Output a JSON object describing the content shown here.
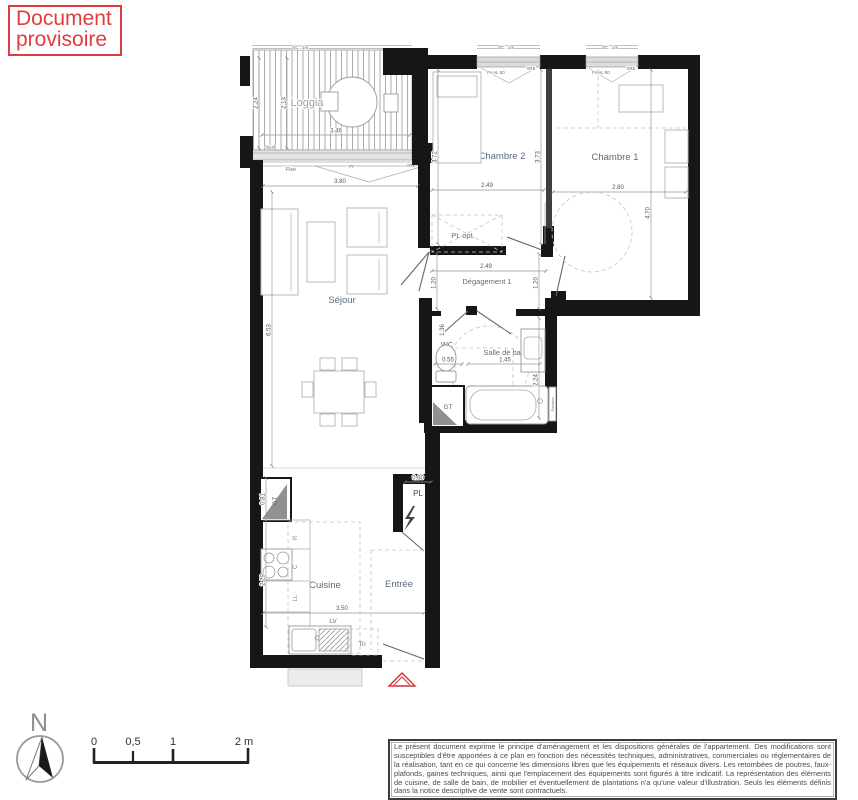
{
  "stamp": {
    "line1": "Document",
    "line2": "provisoire"
  },
  "plan": {
    "rooms": {
      "loggia": {
        "label": "Loggia",
        "width": "3.46",
        "depth_outer": "2.24",
        "depth_inner": "2.13"
      },
      "sejour": {
        "label": "Séjour",
        "width": "3.80",
        "height": "6.53"
      },
      "chambre2": {
        "label": "Chambre 2",
        "width": "2.49",
        "height_left": "3.72",
        "height_right": "3.73"
      },
      "chambre1": {
        "label": "Chambre 1",
        "width": "2.80",
        "height": "4.70"
      },
      "degagement": {
        "label": "Dégagement 1",
        "width": "2.49",
        "height_left": "1.20",
        "height_right": "1.20"
      },
      "wc": {
        "label": "WC",
        "width": "0.55",
        "height": "1.36"
      },
      "salle_de_bain": {
        "label": "Salle de bain",
        "width": "1.45",
        "height": "2.24"
      },
      "cuisine": {
        "label": "Cuisine",
        "width": "3.50",
        "counter_height": "2.29"
      },
      "entree": {
        "label": "Entrée"
      },
      "pl_opt": {
        "label": "PL opt."
      },
      "pl": {
        "label": "PL",
        "width": "0.60"
      }
    },
    "annotations": {
      "gc": "GC : 1m",
      "seuil": "Seuil",
      "fixe": "Fixe",
      "pf": "PF",
      "vre": "VRE",
      "window_tag": "FA AL 50",
      "gt": "GT",
      "gt_height": "0.81",
      "radiateur": "Radiateur",
      "lv": "LV",
      "tri": "Tri",
      "fridge": "R",
      "hob": "C",
      "washer": "LL"
    }
  },
  "compass": {
    "north": "N"
  },
  "scale_bar": {
    "ticks": [
      "0",
      "0,5",
      "1",
      "2 m"
    ]
  },
  "disclaimer": "Le présent document exprime le principe d'aménagement et les dispositions générales de l'appartement. Des modifications sont susceptibles d'être apportées à ce plan en fonction des nécessités techniques, administratives, commerciales ou réglementaires de la réalisation, tant en ce qui concerne les dimensions libres que les équipements et réseaux divers. Les retombées de poutres, faux-plafonds, gaines techniques, ainsi que l'emplacement des équipements sont figurés à titre indicatif. La représentation des éléments de cuisine, de salle de bain, de mobilier et éventuellement de plantations n'a qu'une valeur d'illustration. Seuls les éléments définis dans la notice descriptive de vente sont contractuels."
}
